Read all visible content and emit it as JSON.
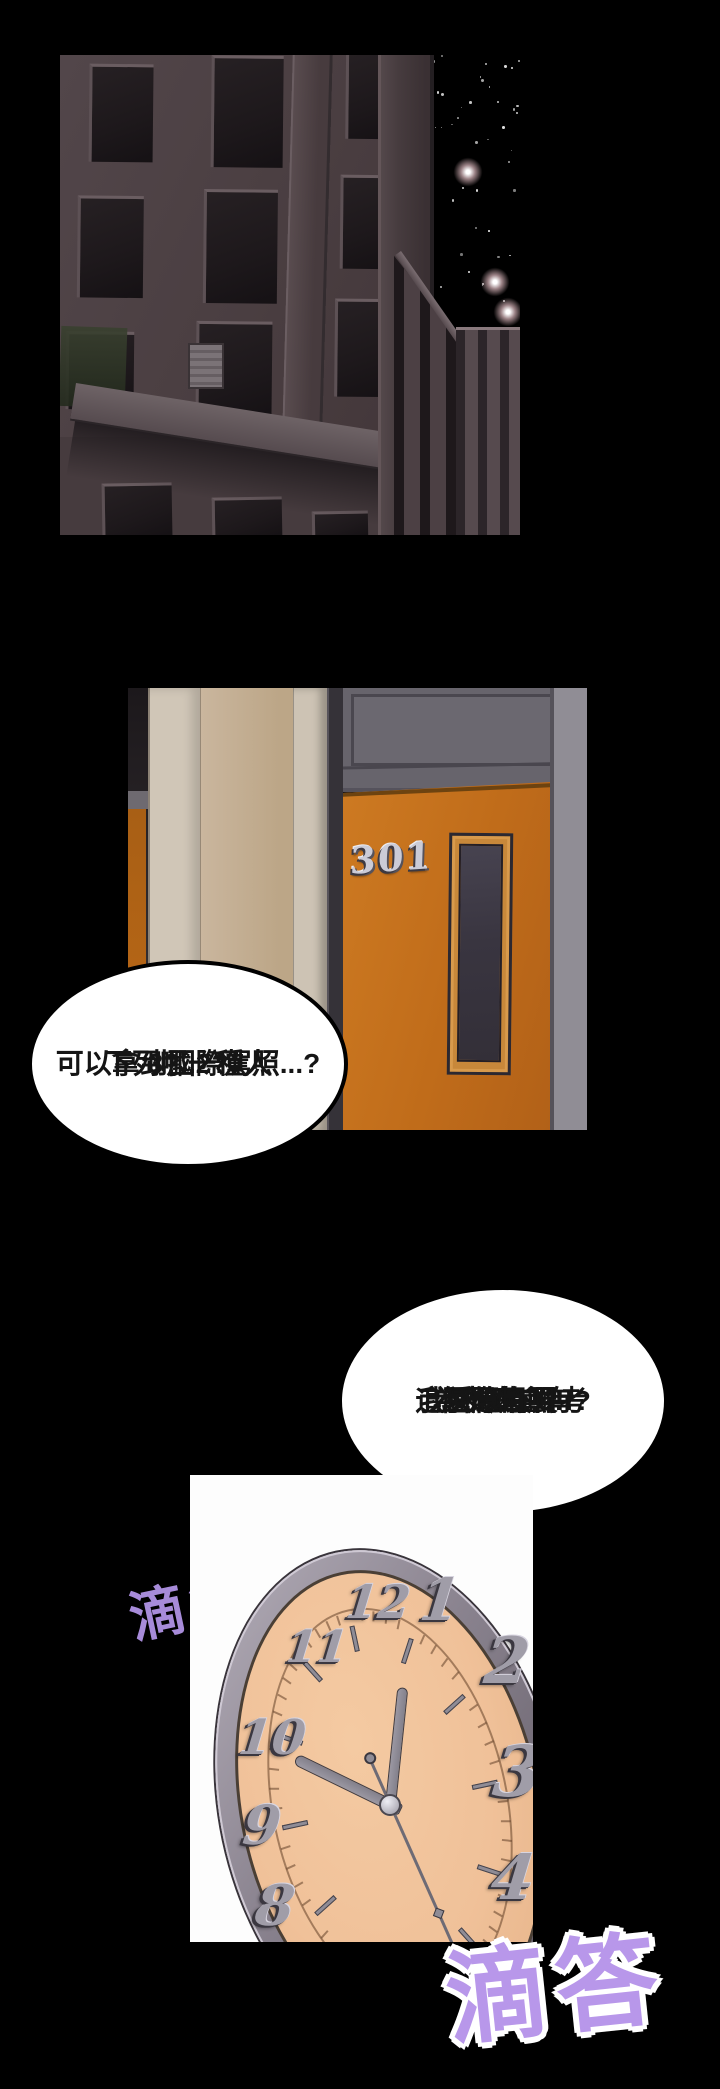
{
  "comic": {
    "room_number": "301",
    "bubbles": {
      "question": {
        "lines": [
          "下列哪一種人",
          "可以拿到國際駕照...?",
          "3?..2?"
        ]
      },
      "reply": {
        "lines": [
          "媽的..",
          "我又沒有要考",
          "國際駕照!",
          "為什麼會有",
          "這種題目啊!!?"
        ]
      }
    },
    "sfx": {
      "tick_small": "滴答",
      "tick_big": "滴答"
    },
    "clock": {
      "numerals": [
        "12",
        "1",
        "2",
        "3",
        "4",
        "8",
        "9",
        "10",
        "11"
      ],
      "hands": {
        "hour_angle_deg": -64,
        "minute_angle_deg": 6,
        "second_angle_deg": 156,
        "time_depicted": "10:00"
      }
    },
    "colors": {
      "door_orange": "#c06c1a",
      "hall_wall_beige": "#c9b59d",
      "hall_frame_gray": "#67646c",
      "clock_face_peach": "#f0c199",
      "clock_rim_gray": "#8a838f",
      "sfx_purple_small": "#a78bd9",
      "sfx_purple_big": "#b897ea",
      "night_wall": "#4a3e41",
      "star_glow_pink": "#eec7cd",
      "bubble_fill": "#ffffff",
      "bubble_outline": "#000000"
    }
  }
}
